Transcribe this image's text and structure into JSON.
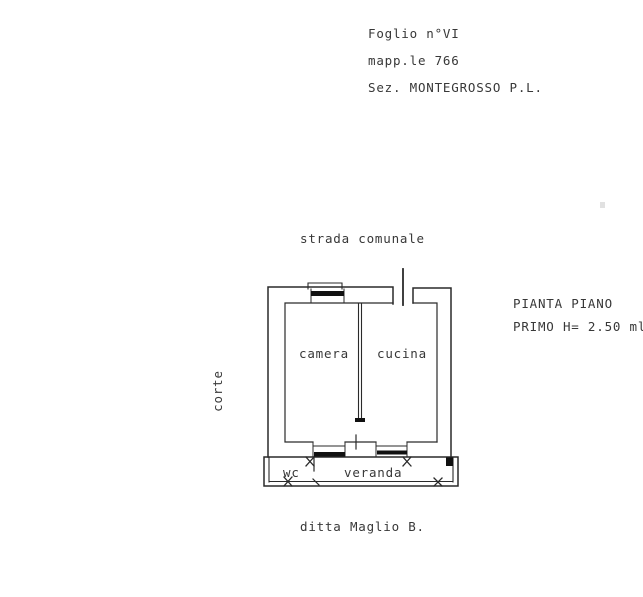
{
  "page": {
    "background": "#ffffff",
    "ink_color": "#2a2a2a",
    "window_fill": "#111111"
  },
  "header": {
    "line1": "Foglio n°VI",
    "line2": "mapp.le 766",
    "line3": "Sez. MONTEGROSSO P.L."
  },
  "plan": {
    "street_label": "strada comunale",
    "courtyard_label": "corte",
    "rooms": {
      "camera": "camera",
      "cucina": "cucina",
      "wc": "wc",
      "veranda": "veranda"
    },
    "title_line1": "PIANTA PIANO",
    "title_line2": "PRIMO H= 2.50 ml"
  },
  "footer": {
    "company": "ditta Maglio B."
  }
}
